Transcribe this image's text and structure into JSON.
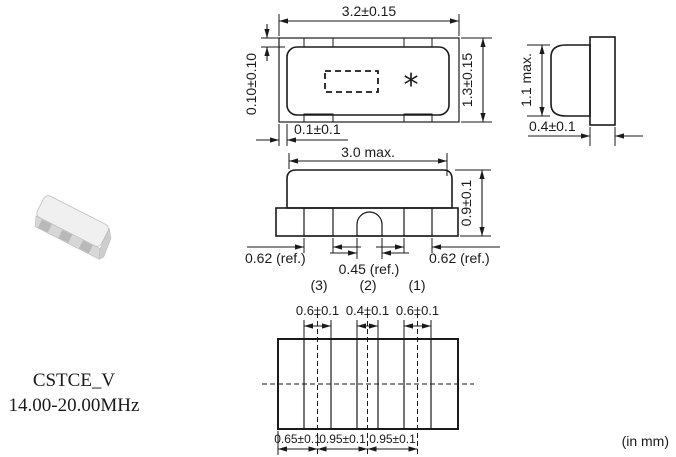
{
  "product": {
    "name": "CSTCE_V",
    "frequency_range": "14.00-20.00MHz"
  },
  "units_note": "(in mm)",
  "colors": {
    "line": "#1a1a1a",
    "body_fill": "#e9e9e9",
    "pad_fill": "#dcdcdc",
    "background": "#ffffff"
  },
  "top_view": {
    "overall_width": "3.2±0.15",
    "overall_height": "1.3±0.15",
    "body_inset_vertical": "0.10±0.10",
    "body_inset_horizontal": "0.1±0.1",
    "polarity_mark": "*"
  },
  "side_view": {
    "max_height": "1.1 max.",
    "terminal_width": "0.4±0.1"
  },
  "front_view": {
    "max_width": "3.0 max.",
    "height": "0.9±0.1",
    "left_pad_width": "0.62 (ref.)",
    "center_pad_width": "0.45 (ref.)",
    "right_pad_width": "0.62 (ref.)",
    "pin3": "(3)",
    "pin2": "(2)",
    "pin1": "(1)"
  },
  "land_pattern": {
    "pad1_width": "0.6±0.1",
    "pad2_width": "0.4±0.1",
    "pad3_width": "0.6±0.1",
    "edge_to_pad1": "0.65±0.1",
    "pad1_to_pad2": "0.95±0.1",
    "pad2_to_pad3": "0.95±0.1"
  }
}
